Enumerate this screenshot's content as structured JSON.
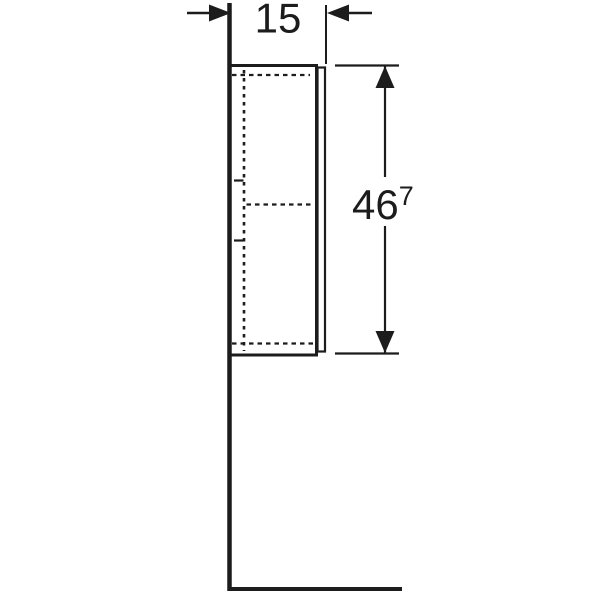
{
  "drawing": {
    "width_dimension": {
      "label": "15"
    },
    "height_dimension": {
      "value": "46",
      "superscript": "7"
    }
  },
  "colors": {
    "line": "#1c1c1c",
    "background": "#ffffff"
  }
}
